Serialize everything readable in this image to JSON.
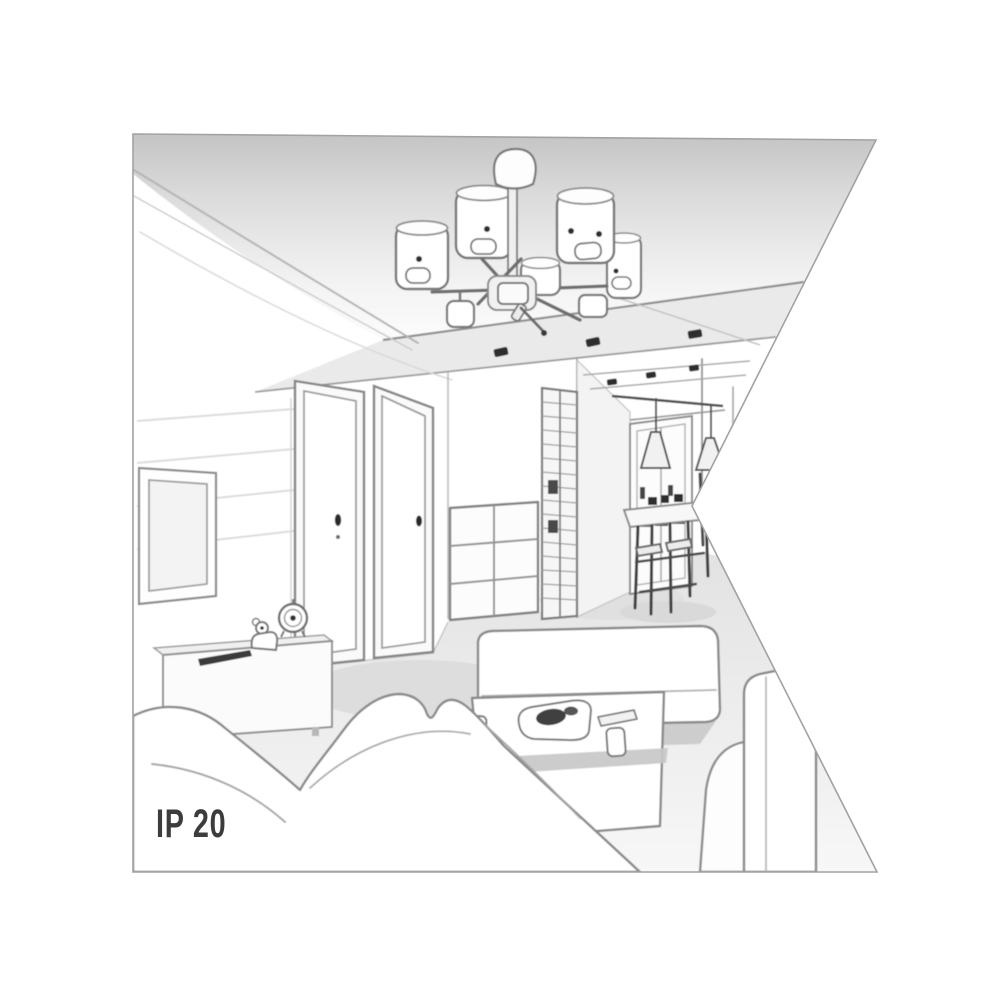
{
  "scene": {
    "description": "Grayscale line-art perspective illustration of a living room interior shown as a lamp product context image; the drawing is clipped by a wedge-shaped notch on the right side.",
    "rating_label": "IP 20",
    "colors": {
      "background": "#ffffff",
      "outline": "#7c7c7c",
      "outline_soft": "#b0b0b0",
      "ceiling_shade_top": "#c4c4c4",
      "ceiling_shade_bottom": "#fdfdfd",
      "floor_shade": "#e2e2e2",
      "accent_dark": "#2d2d2d",
      "label_text": "#3c3c3c"
    },
    "objects": [
      "ceiling-chandelier-with-cylinder-shades",
      "ceiling-canopy",
      "suspended-ceiling-panel",
      "recessed-spotlights",
      "cove-ceiling-curves",
      "left-wall-panels",
      "tv-screen",
      "tv-sideboard",
      "remote-tray",
      "alarm-clock",
      "toy-figure",
      "interior-door-1",
      "interior-door-2",
      "chest-of-drawers",
      "slatted-wardrobe",
      "hallway",
      "hallway-window",
      "pendant-cone-lamps",
      "dining-table",
      "dining-chairs",
      "corner-sofa",
      "ottoman-sofa",
      "right-sofa",
      "right-sofa-armrest",
      "coffee-table",
      "serving-plate",
      "remote-control",
      "cups",
      "floor"
    ]
  }
}
